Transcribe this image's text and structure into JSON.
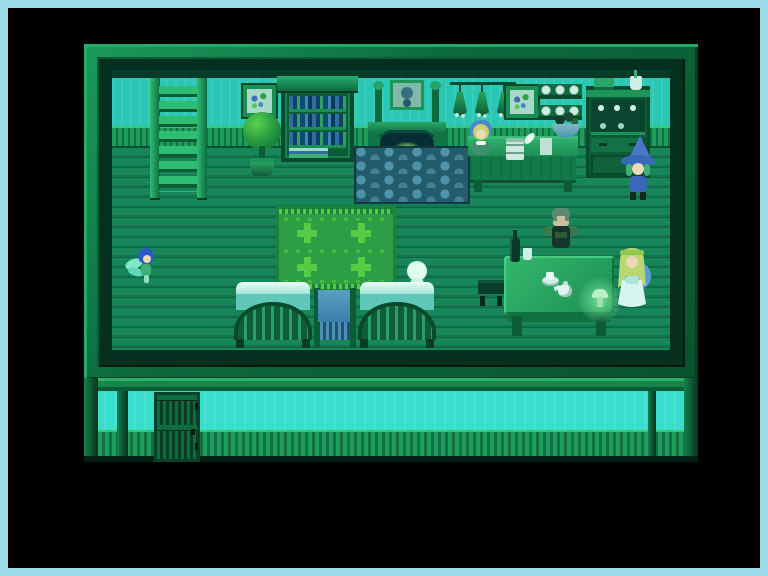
{
  "meta": {
    "app_type": "top-down RPG game screenshot",
    "scene": "inn common room interior at night with teal-green darkness tint; exterior wall strip visible below",
    "hud_text": "none (no visible UI text)"
  },
  "screen": {
    "width": 768,
    "height": 576,
    "outer_border_color": "#9ddbe9",
    "letterbox_color": "#000000"
  },
  "palette": {
    "wall_teal": "#2bc7b5",
    "exterior_teal": "#38decb",
    "floor_green": "#168050",
    "frame_green": "#0c6a3d",
    "rug_green": "#2d9e45",
    "hearth_stone": "#4f93a8",
    "cloth_blue": "#3a7fa8",
    "glow_green": "#aef0c0"
  },
  "entities": {
    "ladder": {
      "label": "wooden ladder to upper floor"
    },
    "painting_left": {
      "label": "framed flower painting"
    },
    "bookshelf": {
      "label": "tall bookshelf with books"
    },
    "potted_plant": {
      "label": "potted topiary plant"
    },
    "fireplace": {
      "label": "stone fireplace with burning fire"
    },
    "portrait": {
      "label": "portrait above mantel"
    },
    "hearth": {
      "label": "cobblestone hearth"
    },
    "herbs": {
      "label": "dried herb bundles hanging on wall"
    },
    "painting_right": {
      "label": "framed flower painting"
    },
    "plate_shelf": {
      "label": "wall shelf with plates"
    },
    "hutch": {
      "label": "kitchen hutch with dishes"
    },
    "counter": {
      "label": "reception counter"
    },
    "clipboard": {
      "label": "guest ledger"
    },
    "quill": {
      "label": "quill pen"
    },
    "paper": {
      "label": "loose paper"
    },
    "basket": {
      "label": "bowl of vegetables"
    },
    "rug": {
      "label": "green patterned rug"
    },
    "bed_left": {
      "label": "inn bed"
    },
    "bed_right": {
      "label": "inn bed"
    },
    "towel_rack": {
      "label": "rack with blue cloth"
    },
    "stool": {
      "label": "small stool"
    },
    "dining_table": {
      "label": "large dining table"
    },
    "wine_bottle": {
      "label": "wine bottle"
    },
    "cup": {
      "label": "drinking cup"
    },
    "teacup": {
      "label": "teacup and saucer"
    },
    "teapot": {
      "label": "teapot"
    },
    "glowing_mushroom": {
      "label": "glowing mushroom item on table"
    },
    "door": {
      "label": "exterior door"
    },
    "exterior_wall": {
      "label": "outside wall of the inn"
    }
  },
  "characters": {
    "innkeeper": {
      "label": "innkeeper woman in blue hood behind counter"
    },
    "witch": {
      "label": "witch with blue pointed hat"
    },
    "fairy": {
      "label": "small blue-haired fairy"
    },
    "ghost": {
      "label": "pale featureless figure by the bed"
    },
    "warrior": {
      "label": "armored man seated at table"
    },
    "fairy_girl": {
      "label": "long-haired girl in pale dress"
    }
  }
}
